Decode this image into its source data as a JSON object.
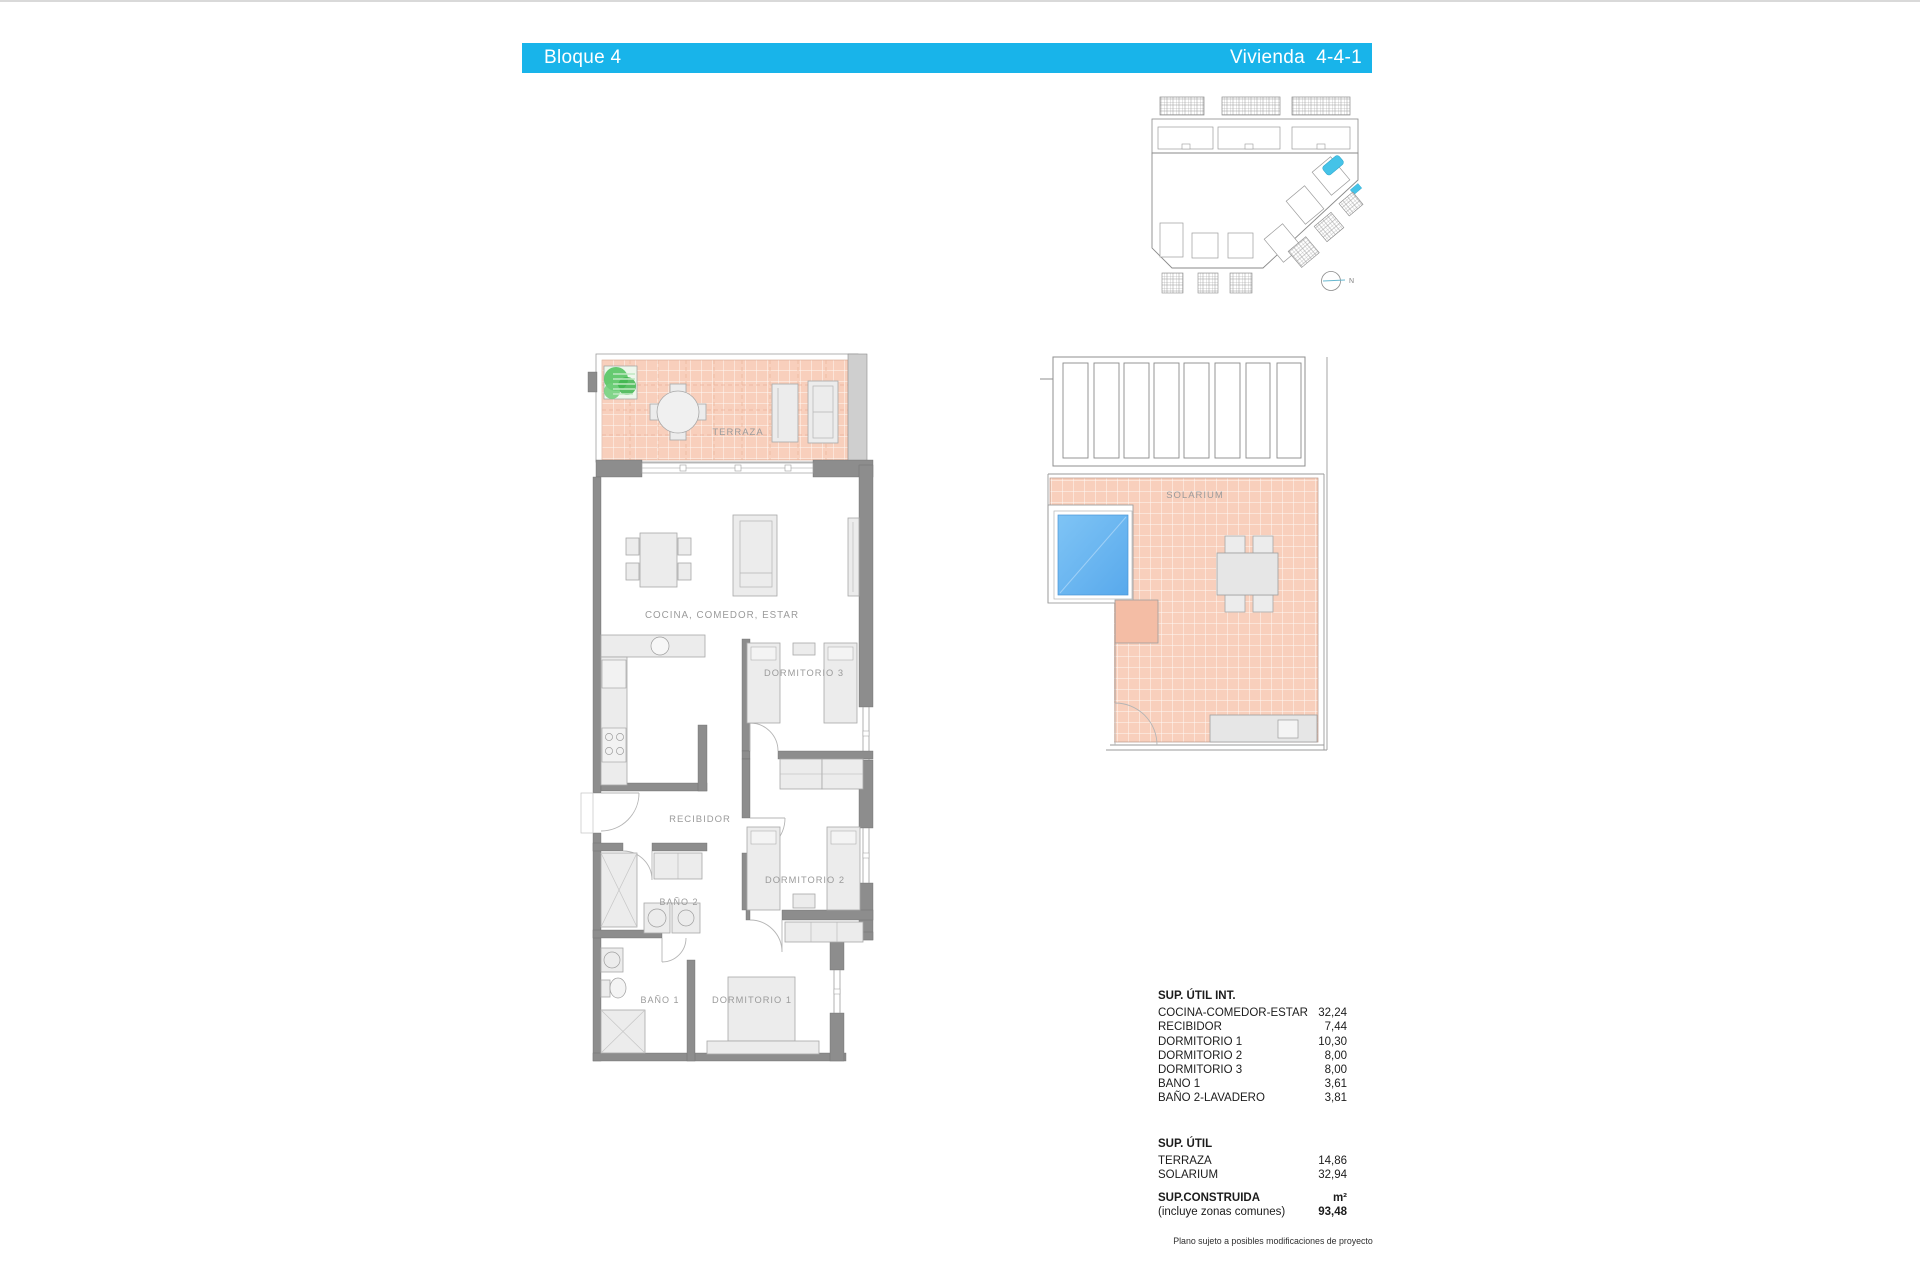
{
  "header": {
    "block_label": "Bloque 4",
    "unit_label": "Vivienda  4-4-1",
    "bar_color": "#18b4ea"
  },
  "site_plan": {
    "compass_label": "N",
    "highlight_color": "#45c3e8"
  },
  "floor_plan": {
    "rooms": {
      "terraza": "TERRAZA",
      "cocina": "COCINA, COMEDOR, ESTAR",
      "dormitorio3": "DORMITORIO 3",
      "recibidor": "RECIBIDOR",
      "dormitorio2": "DORMITORIO 2",
      "bano2": "BAÑO 2",
      "bano1": "BAÑO 1",
      "dormitorio1": "DORMITORIO 1"
    },
    "colors": {
      "tile": "#f8cfbc",
      "wall": "#8d8d8d"
    }
  },
  "solarium": {
    "label": "SOLARIUM",
    "pool_color": "#6cb7f0",
    "tile_color": "#f8cfbc"
  },
  "areas": {
    "util_int_title": "SUP. ÚTIL INT.",
    "util_int_rows": [
      {
        "label": "COCINA-COMEDOR-ESTAR",
        "value": "32,24"
      },
      {
        "label": "RECIBIDOR",
        "value": "7,44"
      },
      {
        "label": "DORMITORIO 1",
        "value": "10,30"
      },
      {
        "label": "DORMITORIO 2",
        "value": "8,00"
      },
      {
        "label": "DORMITORIO 3",
        "value": "8,00"
      },
      {
        "label": "BANO 1",
        "value": "3,61"
      },
      {
        "label": "BAÑO 2-LAVADERO",
        "value": "3,81"
      }
    ],
    "util_title": "SUP. ÚTIL",
    "util_rows": [
      {
        "label": "TERRAZA",
        "value": "14,86"
      },
      {
        "label": "SOLARIUM",
        "value": "32,94"
      }
    ],
    "construida_title": "SUP.CONSTRUIDA",
    "construida_unit": "m²",
    "construida_sub": "(incluye zonas comunes)",
    "construida_value": "93,48"
  },
  "footnote": "Plano sujeto a posibles modificaciones de proyecto"
}
